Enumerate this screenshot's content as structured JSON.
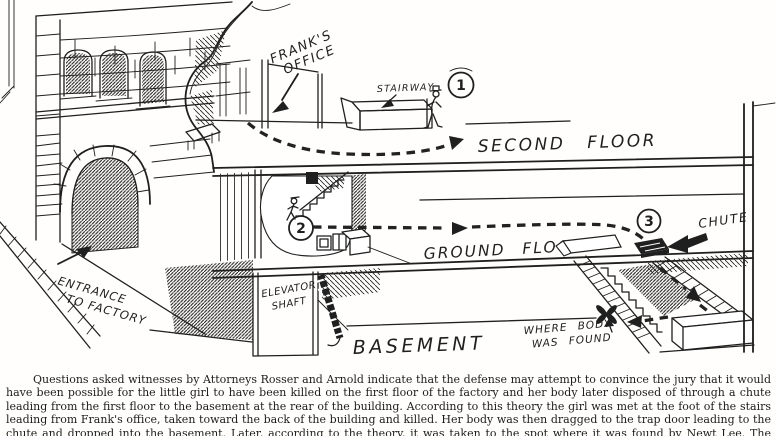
{
  "drawing": {
    "labels": {
      "franks_office_line1": "FRANK'S",
      "franks_office_line2": "OFFICE",
      "stairway": "STAIRWAY",
      "marker1": "1",
      "marker2": "2",
      "marker3": "3",
      "second_floor": "SECOND FLOOR",
      "ground_floor": "GROUND FLOOR",
      "chute": "CHUTE",
      "elevator_line1": "ELEVATOR",
      "elevator_line2": "SHAFT",
      "basement": "BASEMENT",
      "entrance_line1": "ENTRANCE",
      "entrance_line2": "TO FACTORY",
      "body_line1": "WHERE BODY",
      "body_line2": "WAS FOUND"
    },
    "colors": {
      "ink": "#1f1f1f",
      "paper": "#ffffff"
    }
  },
  "caption": {
    "text": "Questions asked witnesses by Attorneys Rosser and Arnold indicate that the defense may attempt to convince the jury that it would have been possible for the little girl to have been killed on the first floor of the factory and her body later disposed of through a chute leading from the first floor to the basement at the rear of the building.  According to this theory the girl was met at the foot of the stairs leading from Frank's office, taken toward the back of the building and killed.  Her body was then dragged to the trap door leading to the chute and dropped into the basement.  Later, according to the theory, it was taken to the spot where it was found by Newt Lee.  The accompanying drawing was made from the model of the factory which is being used by the defense at the trial."
  }
}
